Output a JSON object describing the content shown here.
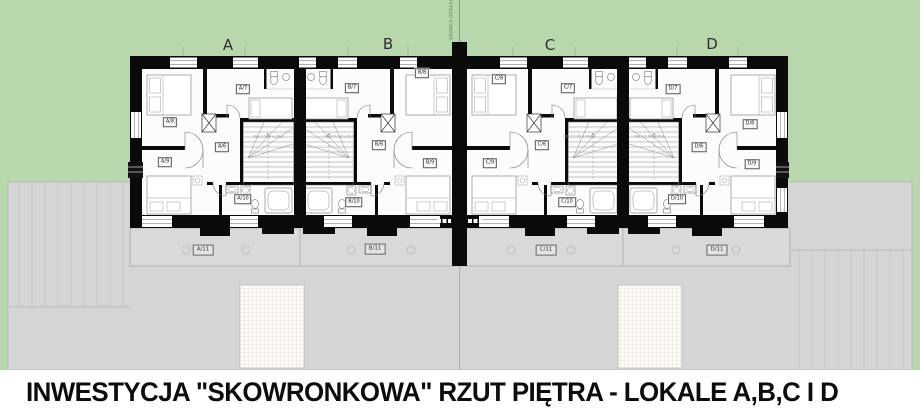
{
  "title": "INWESTYCJA \"SKOWRONKOWA\" RZUT PIĘTRA - LOKALE A,B,C I D",
  "plan": {
    "boundary_label": "GRANICA DZIAŁKI",
    "stair_dimension": "16x 17,78 x 26,9"
  },
  "colors": {
    "grass": "#b9d7ac",
    "pavement": "#d5d5d5",
    "terrace_strip": "#d9d9d9",
    "wall": "#0a0a0a"
  },
  "units": [
    {
      "letter": "A",
      "rooms": {
        "hall": "A/6",
        "top": "A/7",
        "upper_left": "A/8",
        "lower_left": "A/9",
        "bath": "A/10"
      },
      "terrace": "A/11"
    },
    {
      "letter": "B",
      "rooms": {
        "hall": "B/6",
        "top": "B/7",
        "upper_left": "B/8",
        "lower_left": "B/9",
        "bath": "B/10"
      },
      "terrace": "B/11"
    },
    {
      "letter": "C",
      "rooms": {
        "hall": "C/6",
        "top": "C/7",
        "upper_left": "C/8",
        "lower_left": "C/9",
        "bath": "C/10"
      },
      "terrace": "C/11"
    },
    {
      "letter": "D",
      "rooms": {
        "hall": "D/6",
        "top": "D/7",
        "upper_left": "D/8",
        "lower_left": "D/9",
        "bath": "D/10"
      },
      "terrace": "D/11"
    }
  ]
}
